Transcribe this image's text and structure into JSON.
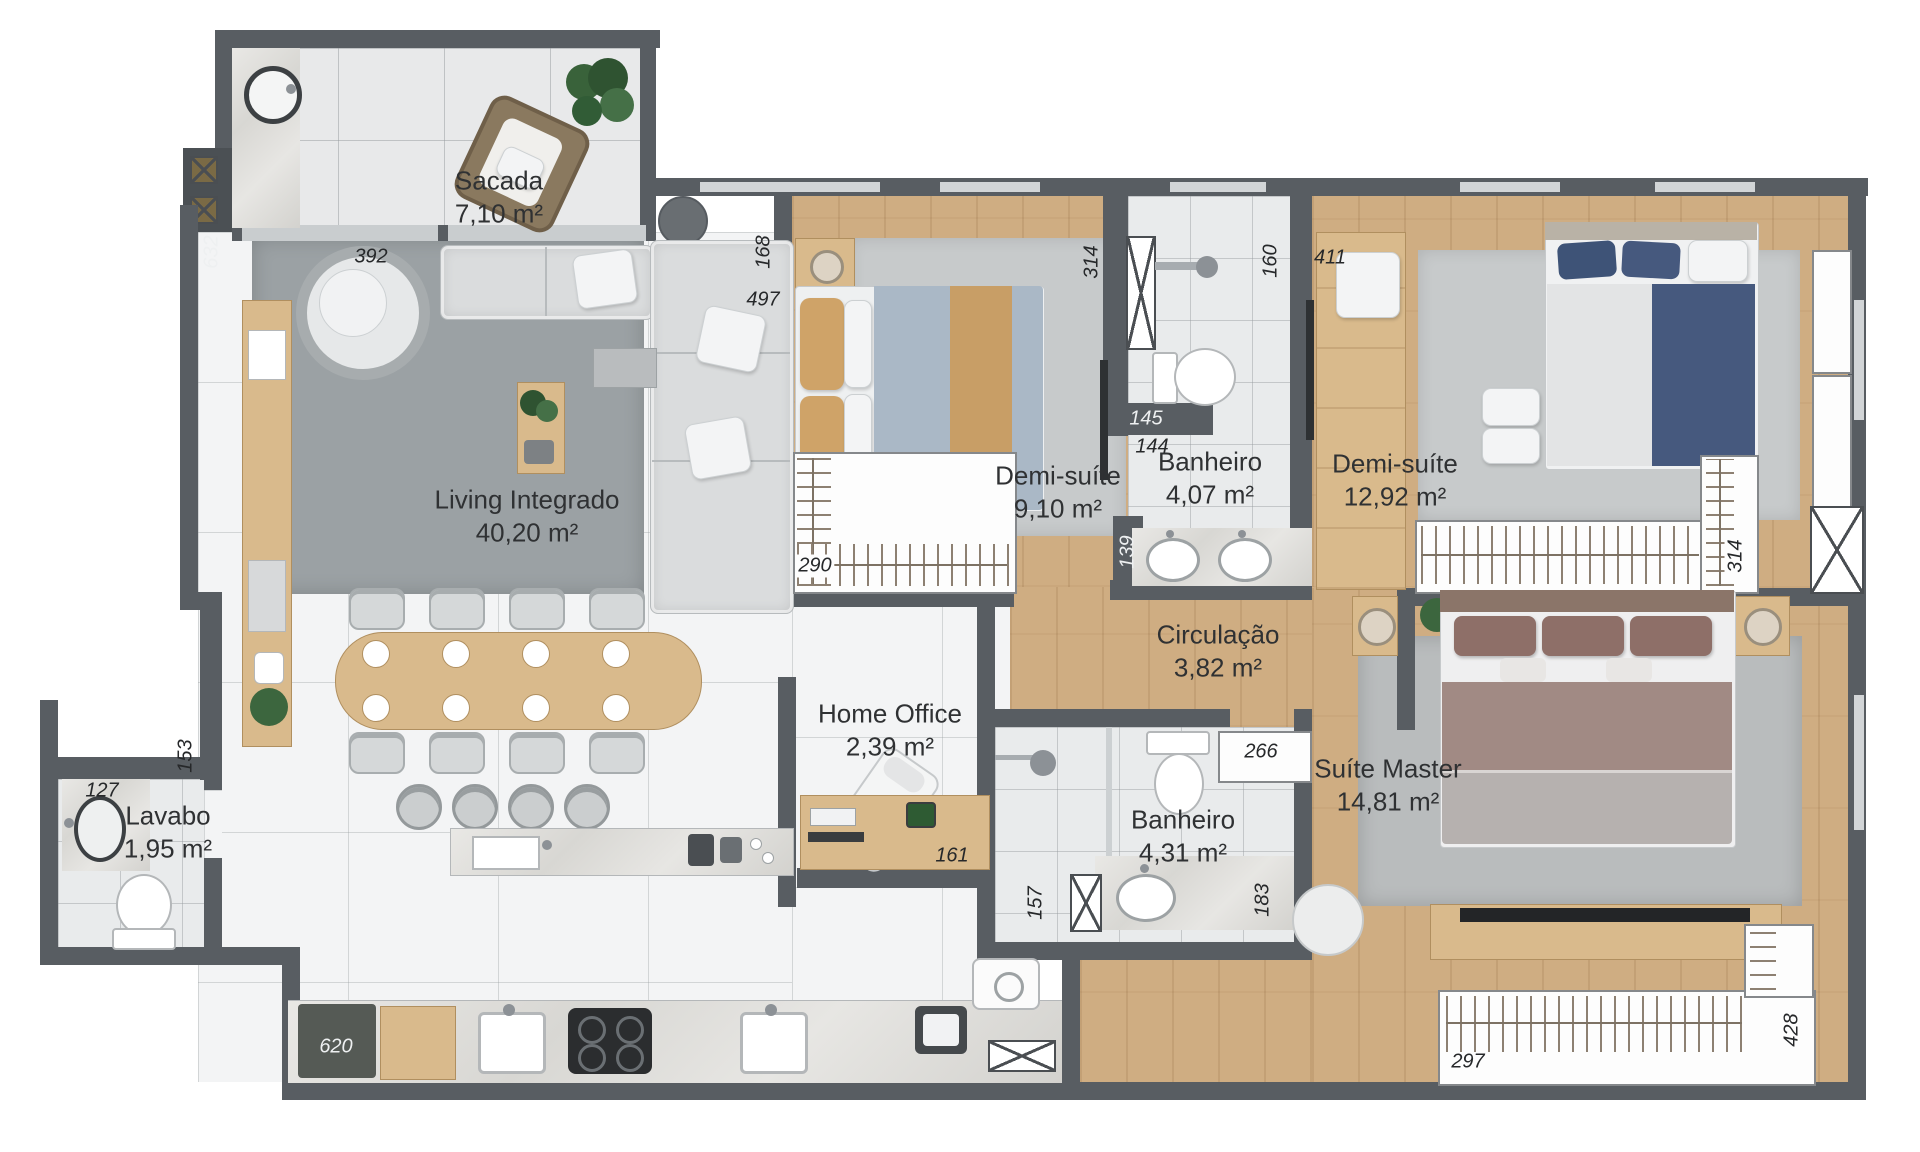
{
  "colors": {
    "wall": "#585d62",
    "wood_floor": "#cfad82",
    "tile_floor": "#f3f4f5",
    "balcony_tile": "#e8e9ea",
    "rug_dark": "#9ba1a4",
    "rug_light": "#c7cacb",
    "marble": "#e6e5e2",
    "furniture_wood": "#d9ba8c",
    "label_text": "#2f3133"
  },
  "rooms": [
    {
      "name": "Sacada",
      "area": "7,10 m²"
    },
    {
      "name": "Living Integrado",
      "area": "40,20 m²"
    },
    {
      "name": "Demi-suíte",
      "area": "9,10 m²"
    },
    {
      "name": "Banheiro",
      "area": "4,07 m²"
    },
    {
      "name": "Demi-suíte",
      "area": "12,92 m²"
    },
    {
      "name": "Circulação",
      "area": "3,82 m²"
    },
    {
      "name": "Home Office",
      "area": "2,39 m²"
    },
    {
      "name": "Banheiro",
      "area": "4,31 m²"
    },
    {
      "name": "Suíte Master",
      "area": "14,81 m²"
    },
    {
      "name": "Lavabo",
      "area": "1,95 m²"
    }
  ],
  "dimensions": [
    {
      "value": "392"
    },
    {
      "value": "632"
    },
    {
      "value": "168"
    },
    {
      "value": "497"
    },
    {
      "value": "290"
    },
    {
      "value": "314"
    },
    {
      "value": "145"
    },
    {
      "value": "144"
    },
    {
      "value": "139"
    },
    {
      "value": "160"
    },
    {
      "value": "411"
    },
    {
      "value": "314"
    },
    {
      "value": "127"
    },
    {
      "value": "153"
    },
    {
      "value": "620"
    },
    {
      "value": "161"
    },
    {
      "value": "157"
    },
    {
      "value": "183"
    },
    {
      "value": "266"
    },
    {
      "value": "297"
    },
    {
      "value": "428"
    }
  ]
}
